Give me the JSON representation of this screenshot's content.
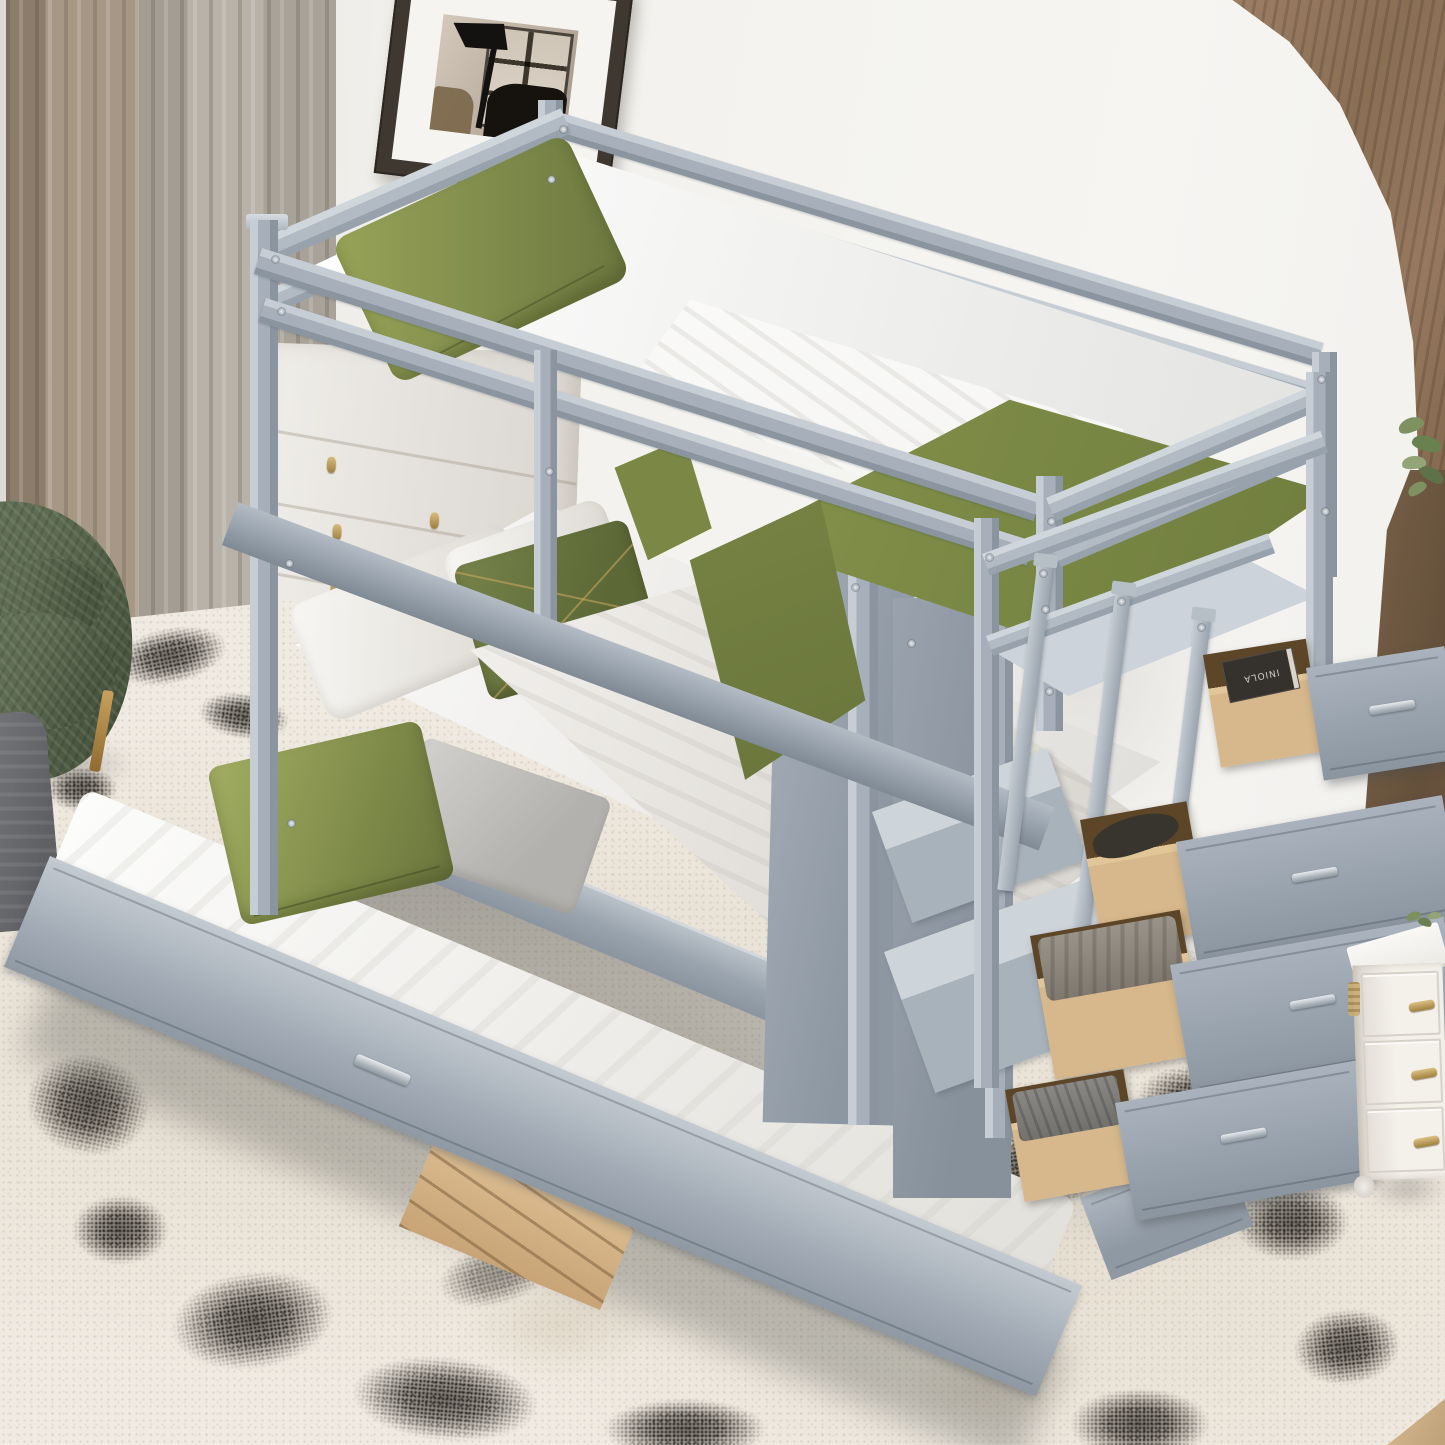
{
  "scene": {
    "type": "product-photo",
    "label": "Gray twin-over-twin wood bunk bed with pull-out trundle and storage-staircase drawers, staged in a bedroom",
    "room": "bedroom with beige curtains, framed artwork, arched wood-panel wall, speckled rug"
  },
  "objects": {
    "bunk_bed": {
      "label": "gray wood bunk bed frame with guard rails"
    },
    "top_bunk": {
      "label": "top bunk: white mattress, olive green pillow, white sheet, olive green blanket"
    },
    "bottom_bunk": {
      "label": "bottom bunk: white pillows, olive accent pillow with gold stitching, white duvet, fringed throw"
    },
    "trundle": {
      "label": "pulled-out trundle bed with white mattress, olive velvet pillow and gray pillow"
    },
    "staircase": {
      "label": "storage staircase with ladder rail and step platforms"
    },
    "drawers": {
      "label": "four open natural-wood storage drawers with gray fronts and metal bar pulls",
      "count": 4,
      "contents": [
        "book",
        "dark slipper",
        "folded gray blanket",
        "gray fabric"
      ]
    },
    "picture_frame": {
      "label": "dark wood framed artwork: lamp silhouette by a window"
    },
    "curtains": {
      "label": "floor-length beige and taupe pleated curtains"
    },
    "armchair": {
      "label": "olive green herringbone armchair with brass leg"
    },
    "pouf": {
      "label": "dark gray ribbed pouf"
    },
    "rug": {
      "label": "ivory rug with black speckled abstract pattern"
    },
    "dresser": {
      "label": "white dresser with small gold pulls behind the bed"
    },
    "nightstand": {
      "label": "white nightstand with ornate gold handles, bun foot and small plant"
    },
    "wood_paneling": {
      "label": "wood-grain wall corner behind a white arched wall cutout"
    },
    "wood_strip": {
      "label": "dark wood wall panel edge with green plant leaves"
    },
    "floor": {
      "label": "light wood floor slivers at rug edges"
    }
  },
  "text": {
    "book_label": "INIOLA"
  },
  "palette": {
    "wall": "#f3f2ee",
    "bed": "#a7b0ba",
    "bed-light": "#c6cdd4",
    "bed-dark": "#8b95a0",
    "mattress": "#f9f9f7",
    "green": "#879349",
    "green-light": "#a3ae63",
    "green-dark": "#67723a",
    "curtain-a": "#a79886",
    "curtain-b": "#b8b2a8",
    "chair": "#5d6b52",
    "pouf": "#6f7074",
    "rug": "#f0ebe2",
    "wood": "#967a5e",
    "strip": "#64503b",
    "dwood": "#d7b88c",
    "gold": "#c2a35f",
    "silver": "#c6cbd1",
    "frame": "#3f3831",
    "floor": "#cfb38c"
  }
}
